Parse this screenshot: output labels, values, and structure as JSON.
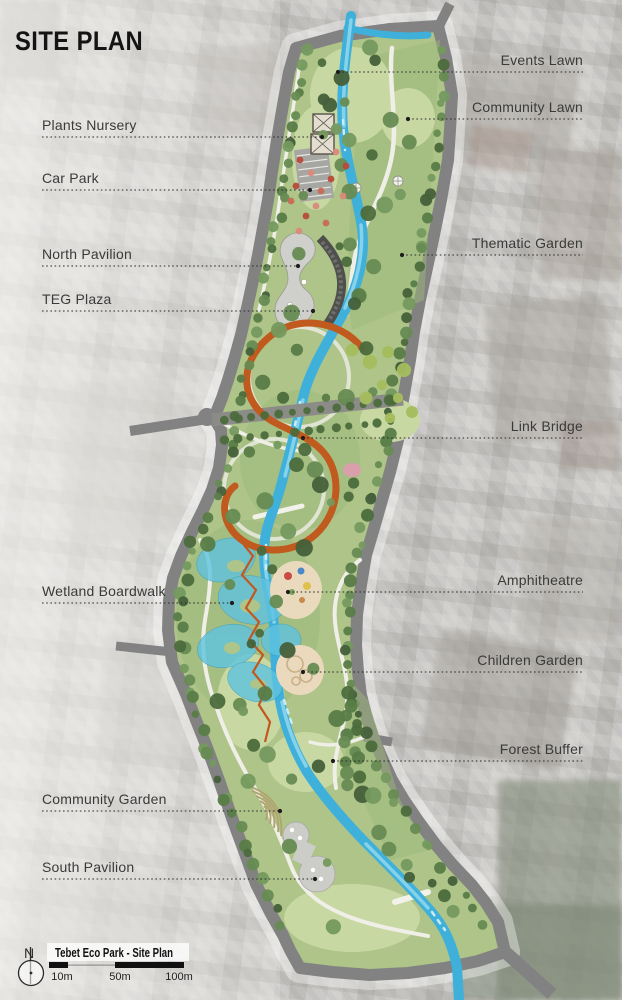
{
  "title": "SITE PLAN",
  "map": {
    "callouts_left": [
      {
        "text": "Plants Nursery",
        "x": 42,
        "line_y": 137,
        "dot_x": 322
      },
      {
        "text": "Car Park",
        "x": 42,
        "line_y": 190,
        "dot_x": 310
      },
      {
        "text": "North Pavilion",
        "x": 42,
        "line_y": 266,
        "dot_x": 298
      },
      {
        "text": "TEG Plaza",
        "x": 42,
        "line_y": 311,
        "dot_x": 313
      },
      {
        "text": "Wetland Boardwalk",
        "x": 42,
        "line_y": 603,
        "dot_x": 232
      },
      {
        "text": "Community Garden",
        "x": 42,
        "line_y": 811,
        "dot_x": 280
      },
      {
        "text": "South Pavilion",
        "x": 42,
        "line_y": 879,
        "dot_x": 315
      }
    ],
    "callouts_right": [
      {
        "text": "Events Lawn",
        "right_x": 583,
        "line_y": 72,
        "dot_x": 338
      },
      {
        "text": "Community Lawn",
        "right_x": 583,
        "line_y": 119,
        "dot_x": 408
      },
      {
        "text": "Thematic Garden",
        "right_x": 583,
        "line_y": 255,
        "dot_x": 402
      },
      {
        "text": "Link Bridge",
        "right_x": 583,
        "line_y": 438,
        "dot_x": 303
      },
      {
        "text": "Amphitheatre",
        "right_x": 583,
        "line_y": 592,
        "dot_x": 288
      },
      {
        "text": "Children Garden",
        "right_x": 583,
        "line_y": 672,
        "dot_x": 303
      },
      {
        "text": "Forest Buffer",
        "right_x": 583,
        "line_y": 761,
        "dot_x": 333
      }
    ]
  },
  "legend": {
    "compass_label": "N",
    "title": "Tebet Eco Park - Site Plan",
    "scale_ticks": [
      {
        "label": "10m",
        "cx": 62
      },
      {
        "label": "50m",
        "cx": 120
      },
      {
        "label": "100m",
        "cx": 179
      }
    ]
  },
  "colors": {
    "park_green": "#aec489",
    "lawn_green": "#c8d8a2",
    "tree_green": "#55764a",
    "river_blue": "#3fb0da",
    "road_gray": "#828282",
    "bridge_orange": "#c05a1e",
    "label_text": "#3a3a3a",
    "background": "#c9c9c7"
  }
}
